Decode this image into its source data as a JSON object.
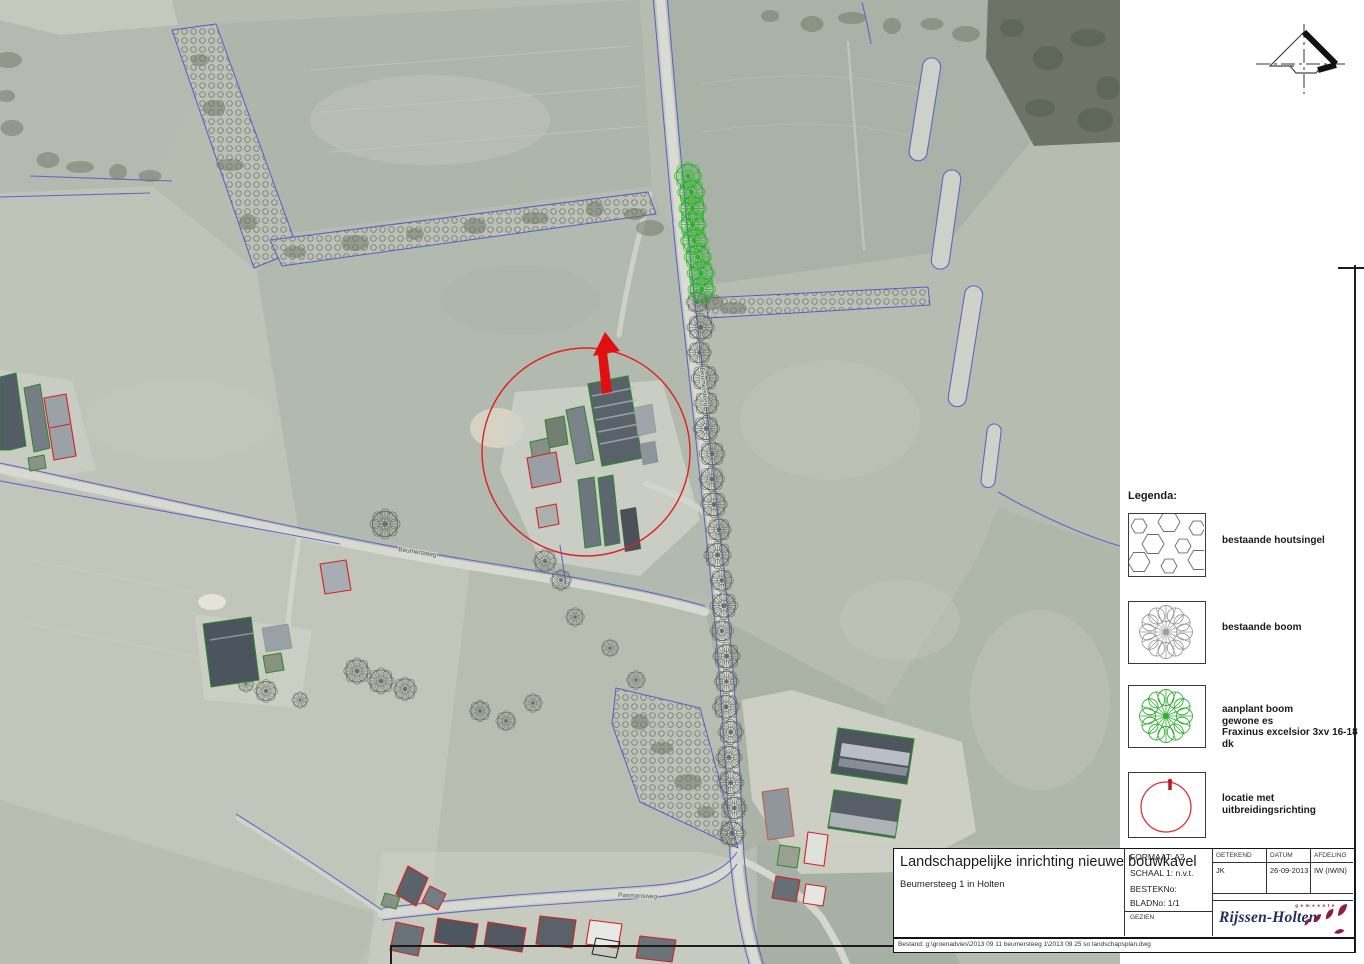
{
  "map": {
    "road_label_main": "Beumersteeg",
    "road_label_west": "Beumersteeg",
    "road_label_south": "Pasmansweg"
  },
  "legend": {
    "title": "Legenda:",
    "items": [
      {
        "name": "existing-hedgerow",
        "label": "bestaande houtsingel"
      },
      {
        "name": "existing-tree",
        "label": "bestaande boom"
      },
      {
        "name": "new-tree",
        "label_lines": [
          "aanplant boom",
          "gewone es",
          "Fraxinus excelsior 3xv 16-18 dk"
        ]
      },
      {
        "name": "location",
        "label": "locatie met uitbreidingsrichting"
      }
    ]
  },
  "title_block": {
    "title": "Landschappelijke inrichting nieuwe bouwkavel",
    "subtitle": "Beumersteeg 1 in Holten",
    "format": "FORMAAT: A2",
    "scale": "SCHAAL 1: n.v.t.",
    "bestek": "BESTEKNo:",
    "blad": "BLADNo: 1/1",
    "gezien": "GEZIEN",
    "drawn_header": "GETEKEND",
    "date_header": "DATUM",
    "dept_header": "AFDELING",
    "drawn_value": "JK",
    "date_value": "26-09-2013",
    "dept_value": "IW (IWIN)",
    "logo_small": "gemeente",
    "logo_name": "Rijssen-Holten",
    "file_label": "Bestand: g:\\groenadvies\\2013 09 11 beumersteeg 1\\2013 09 25 so landschapsplan.dwg"
  },
  "colors": {
    "location_red": "#e02020",
    "new_tree_green": "#1fb41f",
    "ditch_blue": "#5b5bcb",
    "logo_navy": "#242e5f",
    "logo_red": "#8f1d3c"
  }
}
